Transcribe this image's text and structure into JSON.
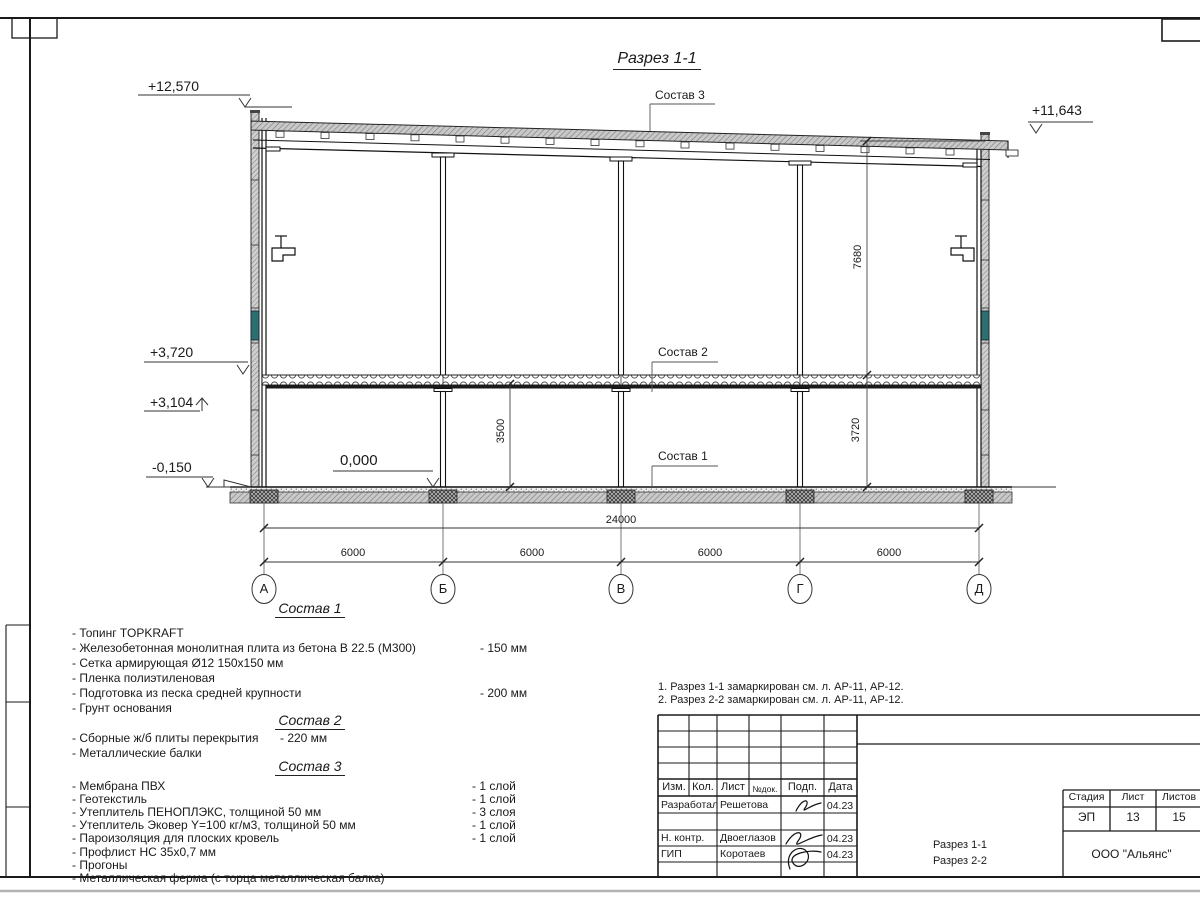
{
  "title": "Разрез 1-1",
  "section_labels": {
    "sostav1": "Состав 1",
    "sostav2": "Состав 2",
    "sostav3": "Состав 3"
  },
  "elevations": {
    "roof_left": "+12,570",
    "roof_right": "+11,643",
    "slab_top": "+3,720",
    "beam_bottom": "+3,104",
    "ground_outside": "-0,150",
    "floor_zero": "0,000"
  },
  "dimensions": {
    "overall": "24000",
    "bay1": "6000",
    "bay2": "6000",
    "bay3": "6000",
    "bay4": "6000",
    "height_upper": "7680",
    "height_lower": "3720",
    "height_room": "3500"
  },
  "axes": [
    "А",
    "Б",
    "В",
    "Г",
    "Д"
  ],
  "compositions": [
    {
      "heading": "Состав 1",
      "items": [
        {
          "text": "- Топинг TOPKRAFT",
          "value": ""
        },
        {
          "text": "- Железобетонная  монолитная плита из бетона  В 22.5 (М300)",
          "value": "- 150 мм"
        },
        {
          "text": "- Сетка армирующая Ø12 150x150 мм",
          "value": ""
        },
        {
          "text": "- Пленка полиэтиленовая",
          "value": ""
        },
        {
          "text": "- Подготовка из песка средней  крупности",
          "value": "- 200 мм"
        },
        {
          "text": "- Грунт основания",
          "value": ""
        }
      ]
    },
    {
      "heading": "Состав 2",
      "items": [
        {
          "text": "- Сборные ж/б плиты перекрытия",
          "value": "- 220 мм"
        },
        {
          "text": "- Металлические балки",
          "value": ""
        }
      ]
    },
    {
      "heading": "Состав 3",
      "items": [
        {
          "text": "- Мембрана ПВХ",
          "value": "- 1 слой"
        },
        {
          "text": "- Геотекстиль",
          "value": "- 1 слой"
        },
        {
          "text": "- Утеплитель ПЕНОПЛЭКС, толщиной 50 мм",
          "value": "- 3 слоя"
        },
        {
          "text": "- Утеплитель Эковер Y=100 кг/м3, толщиной 50 мм",
          "value": "- 1 слой"
        },
        {
          "text": "- Пароизоляция для плоских кровель",
          "value": "- 1 слой"
        },
        {
          "text": "- Профлист НС 35x0,7 мм",
          "value": ""
        },
        {
          "text": "- Прогоны",
          "value": ""
        },
        {
          "text": "- Металлическая ферма (с торца металлическая балка)",
          "value": ""
        }
      ]
    }
  ],
  "notes": [
    "1. Разрез 1-1 замаркирован см. л. АР-11, АР-12.",
    "2. Разрез 2-2 замаркирован см. л. АР-11, АР-12."
  ],
  "title_block": {
    "headers": {
      "izm": "Изм.",
      "kol": "Кол.",
      "list": "Лист",
      "ndok": "№док.",
      "podp": "Подп.",
      "data": "Дата"
    },
    "rows": [
      {
        "role": "Разработал",
        "name": "Решетова",
        "date": "04.23"
      },
      {
        "role": "Н. контр.",
        "name": "Двоеглазов",
        "date": "04.23"
      },
      {
        "role": "ГИП",
        "name": "Коротаев",
        "date": "04.23"
      }
    ],
    "doc_title_line1": "Разрез 1-1",
    "doc_title_line2": "Разрез 2-2",
    "stage_headers": {
      "stage": "Стадия",
      "sheet": "Лист",
      "sheets": "Листов"
    },
    "stage_values": {
      "stage": "ЭП",
      "sheet": "13",
      "sheets": "15"
    },
    "company": "ООО \"Альянс\""
  },
  "colors": {
    "line": "#1a1a1a",
    "hatch_gray": "#c9c9c9",
    "window_teal": "#2d6e6e"
  }
}
